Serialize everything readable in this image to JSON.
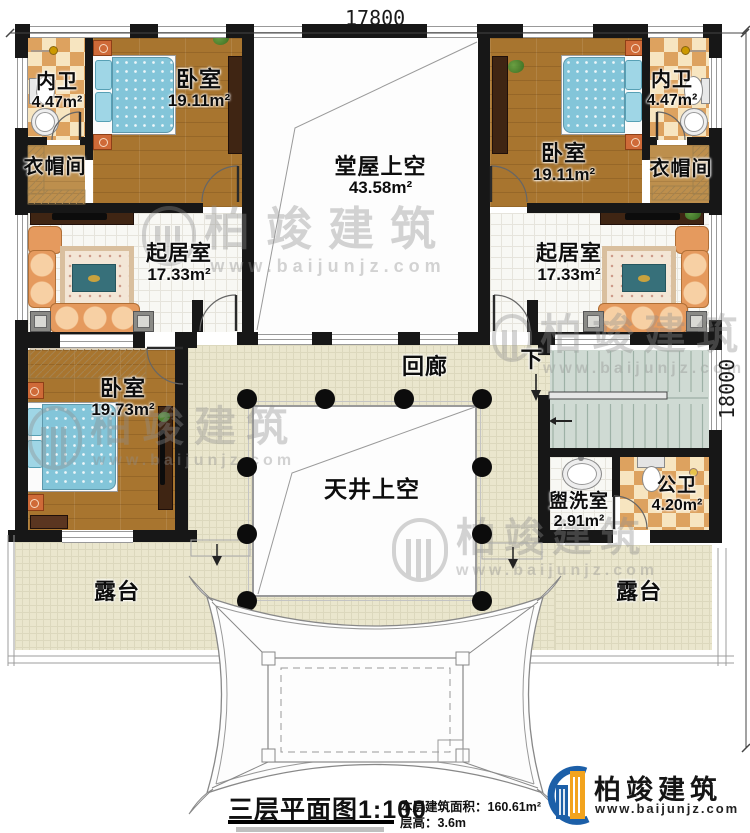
{
  "dimensions": {
    "top": "17800",
    "right": "18000"
  },
  "rooms": {
    "bath_tl": {
      "name": "内卫",
      "area": "4.47m²"
    },
    "bed_tl": {
      "name": "卧室",
      "area": "19.11m²"
    },
    "cloak_l": {
      "name": "衣帽间"
    },
    "hall": {
      "name": "堂屋上空",
      "area": "43.58m²"
    },
    "bed_tr": {
      "name": "卧室",
      "area": "19.11m²"
    },
    "bath_tr": {
      "name": "内卫",
      "area": "4.47m²"
    },
    "cloak_r": {
      "name": "衣帽间"
    },
    "living_l": {
      "name": "起居室",
      "area": "17.33m²"
    },
    "living_r": {
      "name": "起居室",
      "area": "17.33m²"
    },
    "bed_bl": {
      "name": "卧室",
      "area": "19.73m²"
    },
    "corridor": {
      "name": "回廊"
    },
    "courtyard": {
      "name": "天井上空"
    },
    "wash": {
      "name": "盥洗室",
      "area": "2.91m²"
    },
    "wc": {
      "name": "公卫",
      "area": "4.20m²"
    },
    "terrace_l": {
      "name": "露台"
    },
    "terrace_r": {
      "name": "露台"
    },
    "stair_down": {
      "name": "下"
    }
  },
  "footer": {
    "title": "三层平面图",
    "scale": "1:100",
    "area_label": "本层建筑面积：",
    "area_value": "160.61m²",
    "floor_height_label": "层高：",
    "floor_height_value": "3.6m"
  },
  "brand": {
    "name": "柏竣建筑",
    "url": "www.baijunjz.com"
  },
  "watermark": {
    "text": "柏竣建筑",
    "url": "www.baijunjz.com"
  },
  "colors": {
    "wall": "#171717",
    "wood": "#a8752f",
    "bed_blue": "#83c5d9",
    "beige": "#eae6cd",
    "brand_blue": "#1c5fa8",
    "brand_orange": "#f2a31d"
  }
}
